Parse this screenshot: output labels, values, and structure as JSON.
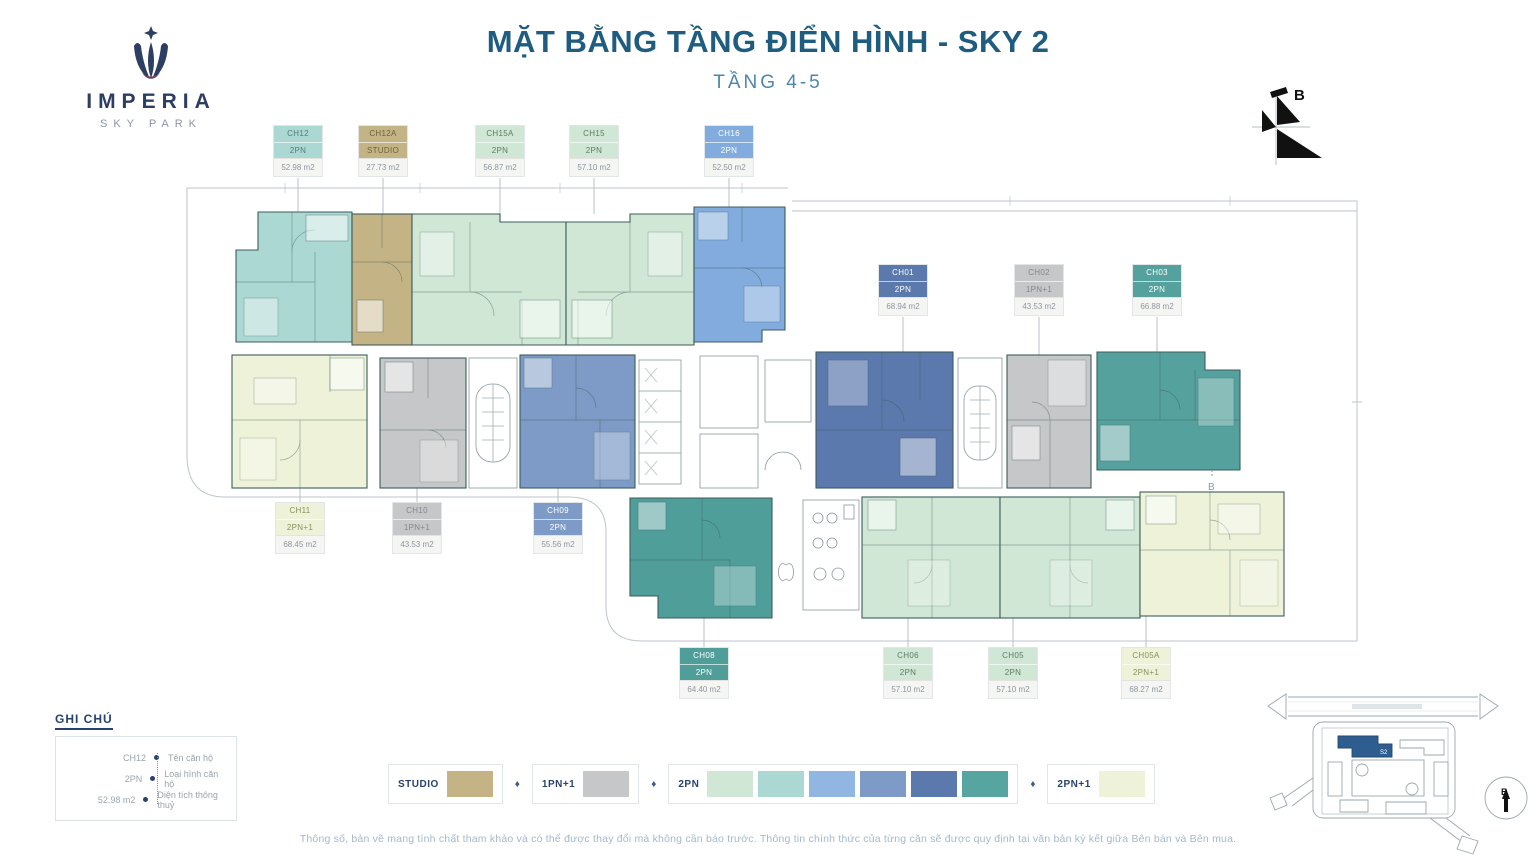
{
  "logo": {
    "brand": "IMPERIA",
    "tagline": "SKY PARK"
  },
  "header": {
    "title": "MẶT BẰNG TẦNG ĐIỂN HÌNH - SKY 2",
    "subtitle": "TẦNG 4-5",
    "title_color": "#1e5c80"
  },
  "compass": {
    "north_label": "B"
  },
  "section_marker": "B",
  "units": [
    {
      "id": "CH12",
      "type": "2PN",
      "area": "52.98 m2",
      "color": "#abd8d3",
      "text_color": "#567a7a"
    },
    {
      "id": "CH12A",
      "type": "STUDIO",
      "area": "27.73 m2",
      "color": "#c4b384",
      "text_color": "#6e6340"
    },
    {
      "id": "CH15A",
      "type": "2PN",
      "area": "56.87 m2",
      "color": "#cfe7d4",
      "text_color": "#5d7a68"
    },
    {
      "id": "CH15",
      "type": "2PN",
      "area": "57.10 m2",
      "color": "#cfe7d4",
      "text_color": "#5d7a68"
    },
    {
      "id": "CH16",
      "type": "2PN",
      "area": "52.50 m2",
      "color": "#82abde",
      "text_color": "#ffffff"
    },
    {
      "id": "CH01",
      "type": "2PN",
      "area": "68.94 m2",
      "color": "#5b79ac",
      "text_color": "#ffffff"
    },
    {
      "id": "CH02",
      "type": "1PN+1",
      "area": "43.53 m2",
      "color": "#c6c7c9",
      "text_color": "#82878c"
    },
    {
      "id": "CH03",
      "type": "2PN",
      "area": "66.88 m2",
      "color": "#55a19d",
      "text_color": "#ffffff"
    },
    {
      "id": "CH11",
      "type": "2PN+1",
      "area": "68.45 m2",
      "color": "#edf2d8",
      "text_color": "#87905f"
    },
    {
      "id": "CH10",
      "type": "1PN+1",
      "area": "43.53 m2",
      "color": "#c6c7c9",
      "text_color": "#82878c"
    },
    {
      "id": "CH09",
      "type": "2PN",
      "area": "55.56 m2",
      "color": "#7d9bc6",
      "text_color": "#ffffff"
    },
    {
      "id": "CH08",
      "type": "2PN",
      "area": "64.40 m2",
      "color": "#4f9e9a",
      "text_color": "#ffffff"
    },
    {
      "id": "CH06",
      "type": "2PN",
      "area": "57.10 m2",
      "color": "#cfe7d4",
      "text_color": "#5d7a68"
    },
    {
      "id": "CH05",
      "type": "2PN",
      "area": "57.10 m2",
      "color": "#cfe7d4",
      "text_color": "#5d7a68"
    },
    {
      "id": "CH05A",
      "type": "2PN+1",
      "area": "68.27 m2",
      "color": "#edf2d8",
      "text_color": "#87905f"
    }
  ],
  "notes": {
    "title": "GHI CHÚ",
    "rows": [
      {
        "key": "CH12",
        "desc": "Tên căn hộ"
      },
      {
        "key": "2PN",
        "desc": "Loại hình căn hộ"
      },
      {
        "key": "52.98 m2",
        "desc": "Diện tích thông thuỷ"
      }
    ]
  },
  "type_legend": {
    "separator": "♦",
    "separator_color": "#3a5f8a",
    "items": [
      {
        "label": "STUDIO",
        "colors": [
          "#c4b384"
        ]
      },
      {
        "label": "1PN+1",
        "colors": [
          "#c6c7c9"
        ]
      },
      {
        "label": "2PN",
        "colors": [
          "#cfe7d4",
          "#abd8d3",
          "#92b6e2",
          "#7d9bc6",
          "#5b79ac",
          "#57a5a0"
        ]
      },
      {
        "label": "2PN+1",
        "colors": [
          "#edf2d8"
        ]
      }
    ]
  },
  "disclaimer": "Thông số, bản vẽ mang tính chất tham khảo và có thể được thay đổi mà không cần báo trước. Thông tin chính thức của từng căn sẽ được quy định tại văn bản ký kết giữa Bên bán và Bên mua.",
  "sitemap": {
    "highlight_label": "S2",
    "north_label": "B"
  }
}
